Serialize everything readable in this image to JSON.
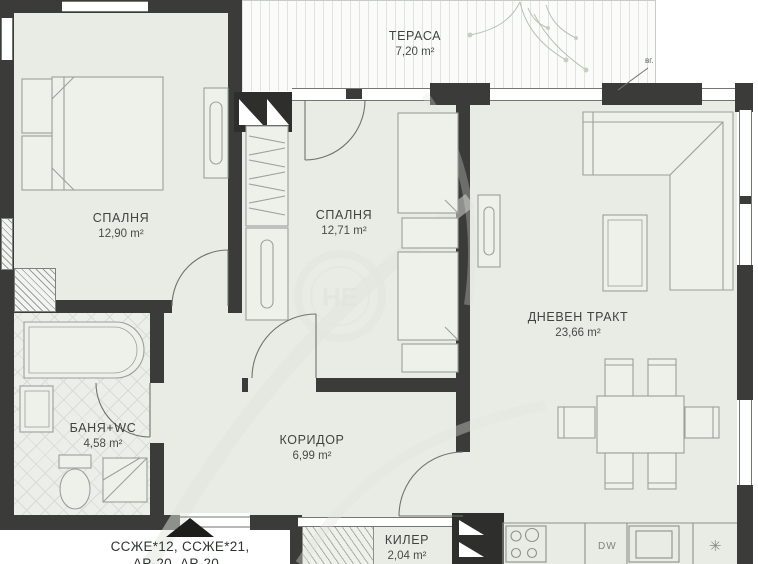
{
  "rooms": [
    {
      "key": "terrace",
      "name": "ТЕРАСА",
      "area": "7,20 m²"
    },
    {
      "key": "bedroom1",
      "name": "СПАЛНЯ",
      "area": "12,90 m²"
    },
    {
      "key": "bedroom2",
      "name": "СПАЛНЯ",
      "area": "12,71 m²"
    },
    {
      "key": "living",
      "name": "ДНЕВЕН ТРАКТ",
      "area": "23,66 m²"
    },
    {
      "key": "bathroom",
      "name": "БАНЯ+WC",
      "area": "4,58 m²"
    },
    {
      "key": "corridor",
      "name": "КОРИДОР",
      "area": "6,99 m²"
    },
    {
      "key": "storage",
      "name": "КИЛЕР",
      "area": "2,04 m²"
    }
  ],
  "kitchen": {
    "dishwasher_label": "DW",
    "appliance_symbol": "✳"
  },
  "annotations": {
    "plan_codes_line1": "ССЖЕ*12, ССЖЕ*21,",
    "plan_codes_line2": "АР-20, АР-20",
    "top_right_note": "вг."
  },
  "watermark": {
    "text": "НЕ"
  },
  "colors": {
    "wall": "#3b3b39",
    "floor": "#e9ebe5",
    "furniture_line": "#9aa19a",
    "text": "#3e443e"
  }
}
